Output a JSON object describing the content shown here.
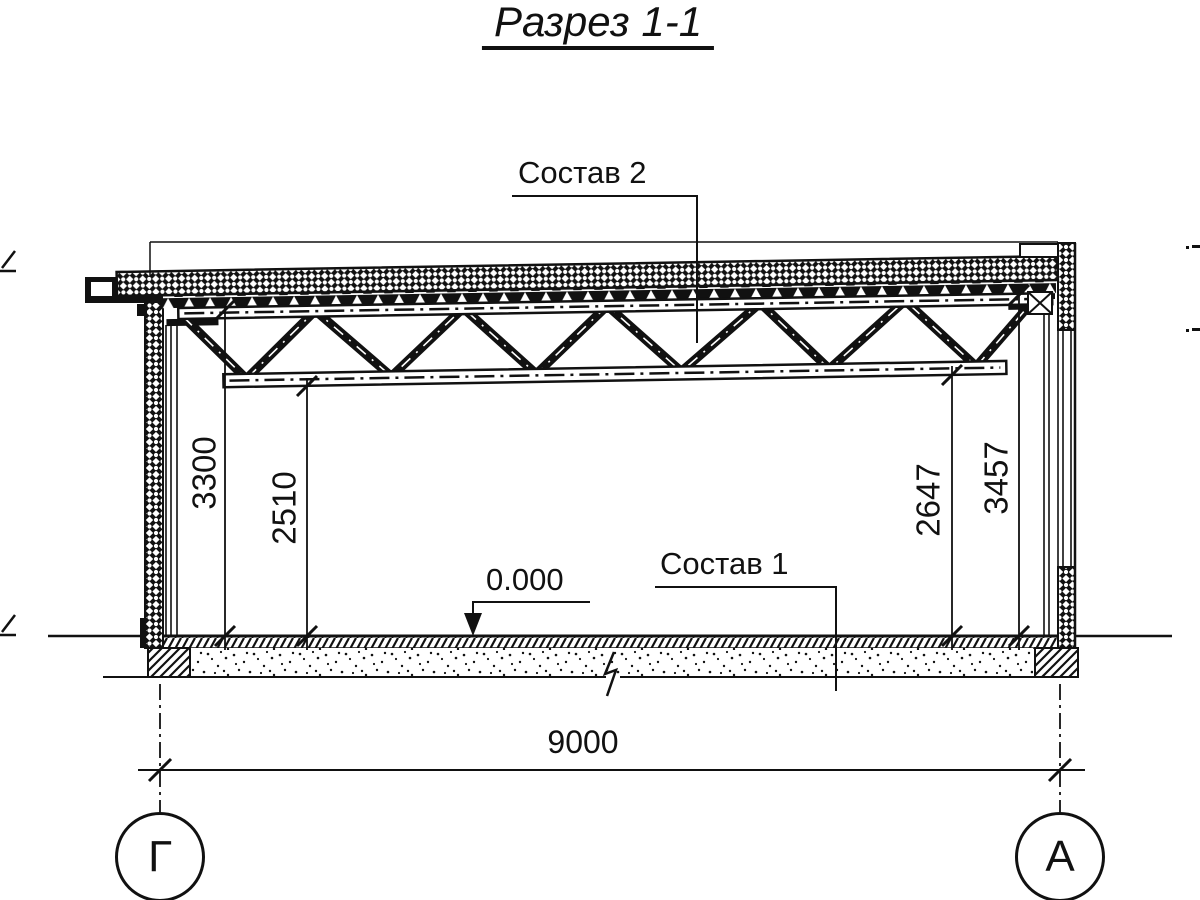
{
  "title": "Разрез 1-1",
  "callouts": {
    "roof": "Состав 2",
    "floor": "Состав 1"
  },
  "elevation_mark": "0.000",
  "dimensions": {
    "left_truss_top": "3300",
    "left_truss_bottom": "2510",
    "right_truss_bottom": "2647",
    "right_truss_top": "3457",
    "span": "9000"
  },
  "axes": {
    "left": "Г",
    "right": "А"
  },
  "colors": {
    "ink": "#111111",
    "paper": "#ffffff"
  }
}
